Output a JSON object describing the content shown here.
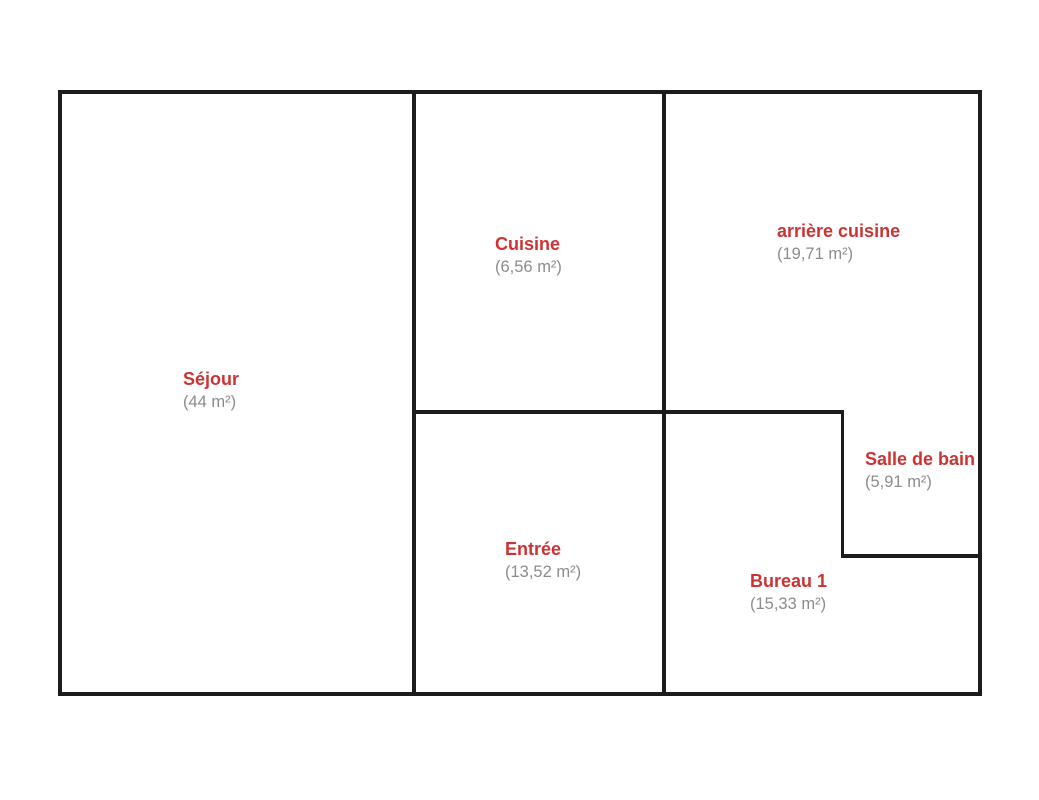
{
  "plan": {
    "type": "floor-plan",
    "colors": {
      "wall": "#1c1c1c",
      "room_name": "#cc3333",
      "room_area": "#8c8c8c",
      "background": "#ffffff"
    },
    "rooms": [
      {
        "id": "sejour",
        "name": "Séjour",
        "area": "(44 m²)"
      },
      {
        "id": "cuisine",
        "name": "Cuisine",
        "area": "(6,56 m²)"
      },
      {
        "id": "arriere-cuisine",
        "name": "arrière cuisine",
        "area": "(19,71 m²)"
      },
      {
        "id": "entree",
        "name": "Entrée",
        "area": "(13,52 m²)"
      },
      {
        "id": "bureau-1",
        "name": "Bureau 1",
        "area": "(15,33 m²)"
      },
      {
        "id": "salle-de-bain",
        "name": "Salle de bain",
        "area": "(5,91 m²)"
      }
    ]
  }
}
